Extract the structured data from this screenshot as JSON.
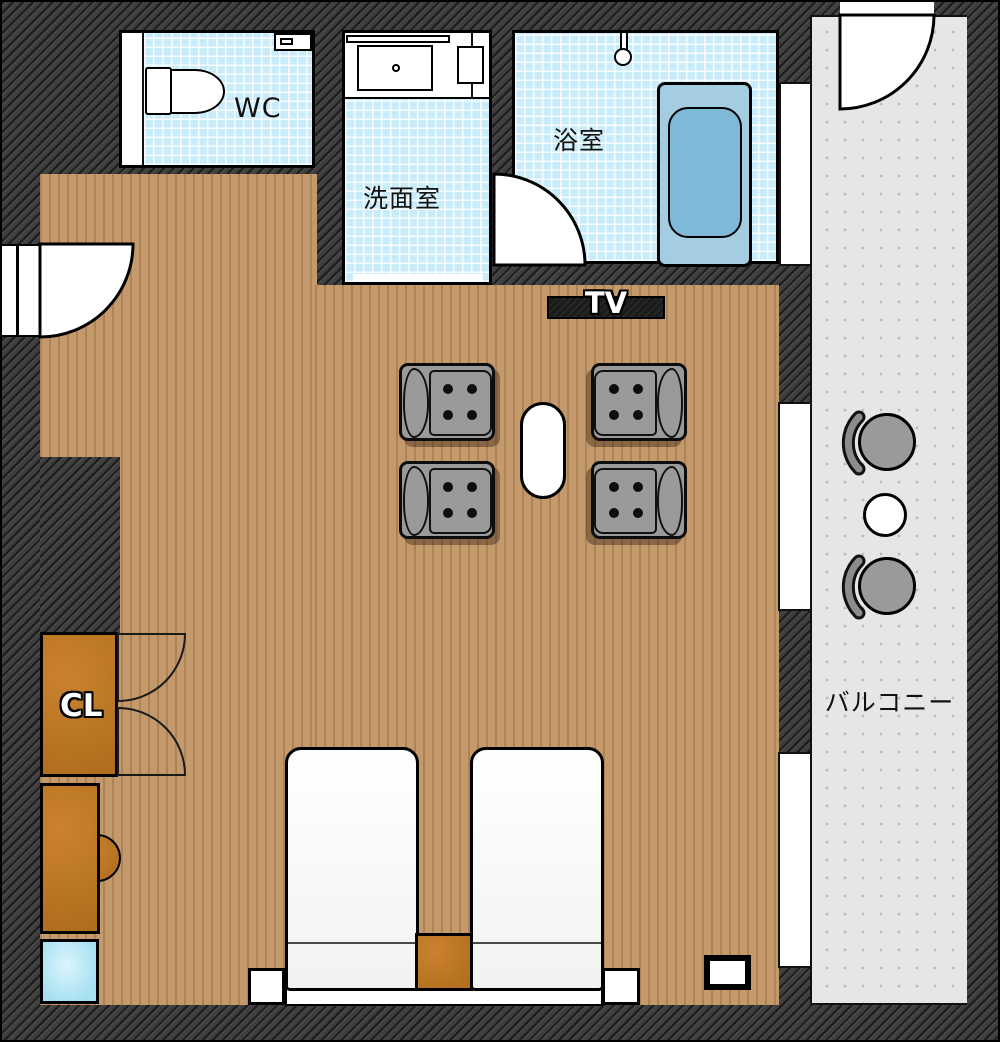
{
  "plan": {
    "title": "apartment-floor-plan",
    "rooms": {
      "wc": {
        "label": "WC"
      },
      "washroom": {
        "label": "洗面室"
      },
      "bathroom": {
        "label": "浴室"
      },
      "closet": {
        "label": "CL"
      },
      "balcony": {
        "label": "バルコニー"
      },
      "living_bedroom": {
        "tv_label": "TV"
      }
    },
    "furniture_icons": [
      "toilet-icon",
      "washbasin-icon",
      "bathtub-icon",
      "shower-icon",
      "door-swing-icon",
      "double-door-swing-icon",
      "tv-icon",
      "armchair-icon",
      "coffee-table-icon",
      "bed-icon",
      "nightstand-icon",
      "desk-icon",
      "stool-icon",
      "laundry-box-icon",
      "balcony-chair-icon",
      "balcony-table-icon",
      "window-icon",
      "outlet-box-icon"
    ],
    "colors": {
      "wall": "#3e3e3e",
      "floor_wood": "#c49a6c",
      "wet_tile": "#c9ecfa",
      "balcony_floor": "#e6e6e6",
      "furniture_orange": "#c4781e",
      "bathtub_outer": "#a5cde2",
      "bathtub_inner": "#7fb9d8",
      "chair_gray": "#9a9a9a",
      "blue_box": "#a8e0f2"
    }
  }
}
